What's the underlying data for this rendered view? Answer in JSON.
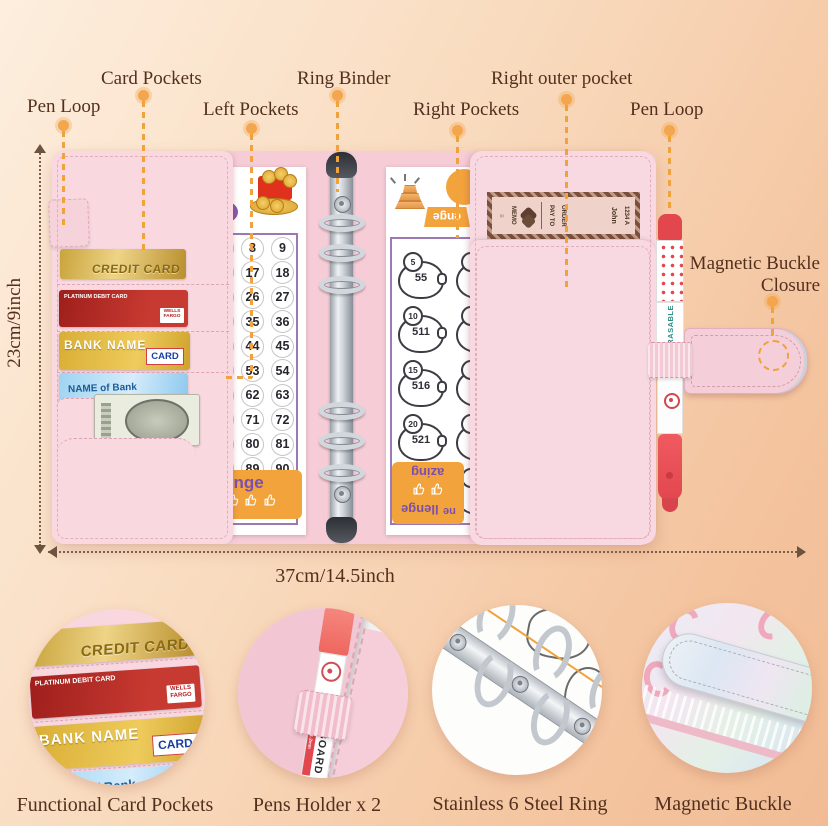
{
  "colors": {
    "accent_orange": "#f0a23c",
    "binder_pink": "#f9d8e0",
    "label_brown": "#53301e",
    "banner_purple": "#7a4fb0"
  },
  "labels": {
    "pen_loop_left": "Pen Loop",
    "card_pockets": "Card Pockets",
    "left_pockets": "Left Pockets",
    "ring_binder": "Ring Binder",
    "right_pockets": "Right Pockets",
    "right_outer_pocket": "Right outer pocket",
    "pen_loop_right": "Pen Loop",
    "magnetic_buckle_line1": "Magnetic Buckle",
    "magnetic_buckle_line2": "Closure"
  },
  "dims": {
    "height": "23cm/9inch",
    "width": "37cm/14.5inch"
  },
  "binder": {
    "cards": {
      "credit": {
        "label": "CREDIT CARD"
      },
      "debit": {
        "label": "PLATINUM DEBIT CARD",
        "brand1": "WELLS",
        "brand2": "FARGO"
      },
      "bank": {
        "label": "BANK NAME",
        "badge": "CARD"
      },
      "blue": {
        "label": "NAME of Bank"
      }
    },
    "number_sheet": {
      "rows": [
        [
          "8",
          "9"
        ],
        [
          "17",
          "18"
        ],
        [
          "26",
          "27"
        ],
        [
          "35",
          "36"
        ],
        [
          "44",
          "45"
        ],
        [
          "53",
          "54"
        ],
        [
          "62",
          "63"
        ],
        [
          "71",
          "72"
        ],
        [
          "80",
          "81"
        ],
        [
          "89",
          "90"
        ]
      ],
      "banner": "enge"
    },
    "piggy_sheet": {
      "trapezoid": "enge",
      "rows": [
        {
          "week": "5",
          "amount": "55"
        },
        {
          "week": "10",
          "amount": "511"
        },
        {
          "week": "15",
          "amount": "516"
        },
        {
          "week": "20",
          "amount": "521"
        },
        {
          "week": "25",
          "amount": "526"
        }
      ],
      "banner_lines": [
        "azing",
        "llenge",
        "ne"
      ]
    },
    "check": {
      "name": "John",
      "address": "1234 A",
      "pay_to": "PAY TO",
      "order": "ORDER",
      "memo": "MEMO"
    },
    "pen": {
      "brand": "ERASABLE"
    }
  },
  "insets": {
    "captions": {
      "card_pockets": "Functional Card Pockets",
      "pens": "Pens Holder x 2",
      "rings": "Stainless 6 Steel Ring",
      "buckle": "Magnetic Buckle"
    },
    "pen_text": "BOARD",
    "pen_label": "ET 1-2mm"
  }
}
